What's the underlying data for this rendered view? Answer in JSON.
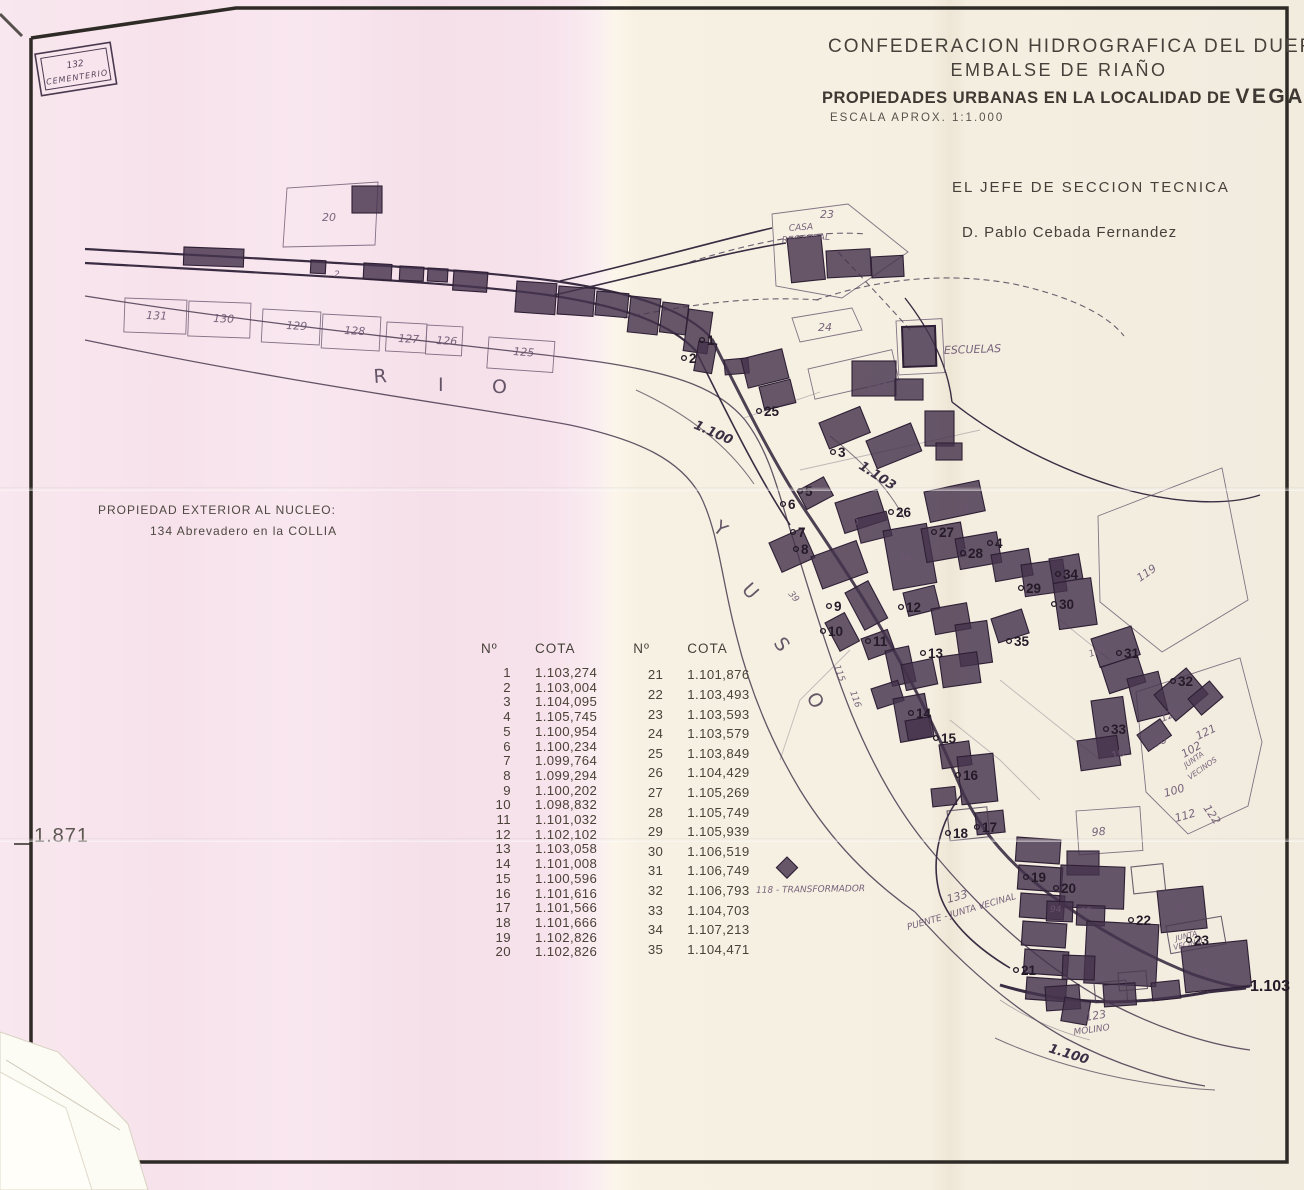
{
  "header": {
    "org": "CONFEDERACION HIDROGRAFICA DEL DUERO",
    "project": "EMBALSE DE RIAÑO",
    "title_prefix": "PROPIEDADES URBANAS EN LA LOCALIDAD DE",
    "title_place": "VEGACERNEJA",
    "scale": "ESCALA APROX. 1:1.000",
    "signature_role": "EL JEFE DE SECCION TECNICA",
    "signature_name": "D. Pablo Cebada Fernandez"
  },
  "sheet_number": "1.871",
  "note": {
    "line1": "PROPIEDAD EXTERIOR AL NUCLEO:",
    "line2": "134  Abrevadero en la COLLIA"
  },
  "table": {
    "col_headers": [
      "Nº",
      "COTA"
    ],
    "left_rows": [
      [
        "1",
        "1.103,274"
      ],
      [
        "2",
        "1.103,004"
      ],
      [
        "3",
        "1.104,095"
      ],
      [
        "4",
        "1.105,745"
      ],
      [
        "5",
        "1.100,954"
      ],
      [
        "6",
        "1.100,234"
      ],
      [
        "7",
        "1.099,764"
      ],
      [
        "8",
        "1.099,294"
      ],
      [
        "9",
        "1.100,202"
      ],
      [
        "10",
        "1.098,832"
      ],
      [
        "11",
        "1.101,032"
      ],
      [
        "12",
        "1.102,102"
      ],
      [
        "13",
        "1.103,058"
      ],
      [
        "14",
        "1.101,008"
      ],
      [
        "15",
        "1.100,596"
      ],
      [
        "16",
        "1.101,616"
      ],
      [
        "17",
        "1.101,566"
      ],
      [
        "18",
        "1.101,666"
      ],
      [
        "19",
        "1.102,826"
      ],
      [
        "20",
        "1.102,826"
      ]
    ],
    "right_rows": [
      [
        "21",
        "1.101,876"
      ],
      [
        "22",
        "1.103,493"
      ],
      [
        "23",
        "1.103,593"
      ],
      [
        "24",
        "1.103,579"
      ],
      [
        "25",
        "1.103,849"
      ],
      [
        "26",
        "1.104,429"
      ],
      [
        "27",
        "1.105,269"
      ],
      [
        "28",
        "1.105,749"
      ],
      [
        "29",
        "1.105,939"
      ],
      [
        "30",
        "1.106,519"
      ],
      [
        "31",
        "1.106,749"
      ],
      [
        "32",
        "1.106,793"
      ],
      [
        "33",
        "1.104,703"
      ],
      [
        "34",
        "1.107,213"
      ],
      [
        "35",
        "1.104,471"
      ]
    ]
  },
  "map": {
    "stamp": {
      "number": "132",
      "label": "CEMENTERIO"
    },
    "labels": [
      {
        "t": "R",
        "x": 374,
        "y": 383,
        "r": -4,
        "c": "river"
      },
      {
        "t": "I",
        "x": 438,
        "y": 391,
        "r": 0,
        "c": "river"
      },
      {
        "t": "O",
        "x": 492,
        "y": 393,
        "r": 0,
        "c": "river"
      },
      {
        "t": "Y",
        "x": 712,
        "y": 530,
        "r": 38,
        "c": "river"
      },
      {
        "t": "U",
        "x": 741,
        "y": 590,
        "r": 48,
        "c": "river"
      },
      {
        "t": "S",
        "x": 773,
        "y": 643,
        "r": 55,
        "c": "river"
      },
      {
        "t": "O",
        "x": 806,
        "y": 697,
        "r": 60,
        "c": "river"
      },
      {
        "t": "1.100",
        "x": 693,
        "y": 428,
        "r": 24,
        "c": "contour"
      },
      {
        "t": "1.103",
        "x": 858,
        "y": 468,
        "r": 33,
        "c": "contour"
      },
      {
        "t": "1.100",
        "x": 1048,
        "y": 1052,
        "r": 17,
        "c": "contour"
      },
      {
        "t": "1.103",
        "x": 1250,
        "y": 991,
        "r": 0,
        "c": "contour-big"
      },
      {
        "t": "ESCUELAS",
        "x": 944,
        "y": 354,
        "r": -2,
        "c": "hand"
      },
      {
        "t": "CASA",
        "x": 789,
        "y": 231,
        "r": -4,
        "c": "hand-s"
      },
      {
        "t": "RECTORAL",
        "x": 782,
        "y": 243,
        "r": -4,
        "c": "hand-s"
      },
      {
        "t": "118 - TRANSFORMADOR",
        "x": 756,
        "y": 893,
        "r": -1,
        "c": "hand-s"
      },
      {
        "t": "PUENTE - JUNTA VECINAL",
        "x": 908,
        "y": 930,
        "r": -16,
        "c": "hand-s"
      },
      {
        "t": "133",
        "x": 948,
        "y": 903,
        "r": -16,
        "c": "hand"
      },
      {
        "t": "123",
        "x": 1086,
        "y": 1021,
        "r": -10,
        "c": "hand"
      },
      {
        "t": "MOLINO",
        "x": 1074,
        "y": 1035,
        "r": -8,
        "c": "hand-s"
      },
      {
        "t": "JUNTA",
        "x": 1176,
        "y": 941,
        "r": -14,
        "c": "hand-t"
      },
      {
        "t": "VECINAL",
        "x": 1174,
        "y": 950,
        "r": -14,
        "c": "hand-t"
      },
      {
        "t": "JUNTA",
        "x": 1186,
        "y": 768,
        "r": -35,
        "c": "hand-t"
      },
      {
        "t": "VECINOS",
        "x": 1190,
        "y": 780,
        "r": -35,
        "c": "hand-t"
      },
      {
        "t": "131",
        "x": 146,
        "y": 319,
        "r": 2,
        "c": "hand"
      },
      {
        "t": "130",
        "x": 213,
        "y": 322,
        "r": 2,
        "c": "hand"
      },
      {
        "t": "129",
        "x": 286,
        "y": 329,
        "r": 3,
        "c": "hand"
      },
      {
        "t": "128",
        "x": 344,
        "y": 334,
        "r": 3,
        "c": "hand"
      },
      {
        "t": "127",
        "x": 398,
        "y": 342,
        "r": 3,
        "c": "hand"
      },
      {
        "t": "126",
        "x": 436,
        "y": 344,
        "r": 3,
        "c": "hand"
      },
      {
        "t": "125",
        "x": 513,
        "y": 355,
        "r": 4,
        "c": "hand"
      },
      {
        "t": "124",
        "x": 868,
        "y": 394,
        "r": -13,
        "c": "hand"
      },
      {
        "t": "20",
        "x": 322,
        "y": 221,
        "r": 0,
        "c": "hand"
      },
      {
        "t": "23",
        "x": 820,
        "y": 218,
        "r": 0,
        "c": "hand"
      },
      {
        "t": "24",
        "x": 818,
        "y": 331,
        "r": 0,
        "c": "hand"
      },
      {
        "t": "2",
        "x": 334,
        "y": 277,
        "r": 0,
        "c": "hand-s"
      },
      {
        "t": "119",
        "x": 1140,
        "y": 582,
        "r": -35,
        "c": "hand"
      },
      {
        "t": "120",
        "x": 1162,
        "y": 722,
        "r": -22,
        "c": "hand"
      },
      {
        "t": "121",
        "x": 1198,
        "y": 740,
        "r": -26,
        "c": "hand"
      },
      {
        "t": "122",
        "x": 1203,
        "y": 808,
        "r": 55,
        "c": "hand"
      },
      {
        "t": "102",
        "x": 1184,
        "y": 758,
        "r": -30,
        "c": "hand"
      },
      {
        "t": "106",
        "x": 1148,
        "y": 750,
        "r": -22,
        "c": "hand"
      },
      {
        "t": "107",
        "x": 1113,
        "y": 760,
        "r": -22,
        "c": "hand"
      },
      {
        "t": "100",
        "x": 1165,
        "y": 797,
        "r": -16,
        "c": "hand"
      },
      {
        "t": "112",
        "x": 1176,
        "y": 822,
        "r": -16,
        "c": "hand"
      },
      {
        "t": "98",
        "x": 1092,
        "y": 836,
        "r": -5,
        "c": "hand"
      },
      {
        "t": "115",
        "x": 834,
        "y": 666,
        "r": 70,
        "c": "hand-s"
      },
      {
        "t": "116",
        "x": 850,
        "y": 692,
        "r": 70,
        "c": "hand-s"
      },
      {
        "t": "39",
        "x": 788,
        "y": 594,
        "r": 50,
        "c": "hand-s"
      },
      {
        "t": "109",
        "x": 1090,
        "y": 657,
        "r": -20,
        "c": "hand-s"
      },
      {
        "t": "96",
        "x": 1070,
        "y": 888,
        "r": 0,
        "c": "hand-s"
      },
      {
        "t": "95",
        "x": 1080,
        "y": 914,
        "r": 0,
        "c": "hand-s"
      },
      {
        "t": "94",
        "x": 1050,
        "y": 912,
        "r": 0,
        "c": "hand-s"
      },
      {
        "t": "77",
        "x": 1112,
        "y": 952,
        "r": 0,
        "c": "hand-s"
      },
      {
        "t": "92",
        "x": 1204,
        "y": 974,
        "r": -6,
        "c": "hand-s"
      },
      {
        "t": "97",
        "x": 1158,
        "y": 996,
        "r": -4,
        "c": "hand-t"
      },
      {
        "t": "76",
        "x": 1174,
        "y": 914,
        "r": -6,
        "c": "hand-s"
      },
      {
        "t": "40",
        "x": 848,
        "y": 527,
        "r": -14,
        "c": "hand-s"
      },
      {
        "t": "16",
        "x": 958,
        "y": 513,
        "r": -8,
        "c": "hand-s"
      },
      {
        "t": "44",
        "x": 900,
        "y": 562,
        "r": -10,
        "c": "hand-s"
      },
      {
        "t": "43",
        "x": 962,
        "y": 556,
        "r": -10,
        "c": "hand-s"
      },
      {
        "t": "54",
        "x": 1066,
        "y": 608,
        "r": -8,
        "c": "hand-s"
      }
    ],
    "markers": [
      {
        "n": "1",
        "x": 702,
        "y": 340
      },
      {
        "n": "2",
        "x": 684,
        "y": 358
      },
      {
        "n": "3",
        "x": 833,
        "y": 452
      },
      {
        "n": "4",
        "x": 990,
        "y": 543
      },
      {
        "n": "5",
        "x": 800,
        "y": 491
      },
      {
        "n": "6",
        "x": 783,
        "y": 504
      },
      {
        "n": "7",
        "x": 793,
        "y": 532
      },
      {
        "n": "8",
        "x": 796,
        "y": 549
      },
      {
        "n": "9",
        "x": 829,
        "y": 606
      },
      {
        "n": "10",
        "x": 823,
        "y": 631
      },
      {
        "n": "11",
        "x": 868,
        "y": 641
      },
      {
        "n": "12",
        "x": 901,
        "y": 607
      },
      {
        "n": "13",
        "x": 923,
        "y": 653
      },
      {
        "n": "14",
        "x": 911,
        "y": 713
      },
      {
        "n": "15",
        "x": 936,
        "y": 738
      },
      {
        "n": "16",
        "x": 958,
        "y": 775
      },
      {
        "n": "17",
        "x": 977,
        "y": 827
      },
      {
        "n": "18",
        "x": 948,
        "y": 833
      },
      {
        "n": "19",
        "x": 1026,
        "y": 877
      },
      {
        "n": "20",
        "x": 1056,
        "y": 888
      },
      {
        "n": "21",
        "x": 1016,
        "y": 970
      },
      {
        "n": "22",
        "x": 1131,
        "y": 920
      },
      {
        "n": "23",
        "x": 1189,
        "y": 940
      },
      {
        "n": "25",
        "x": 759,
        "y": 411
      },
      {
        "n": "26",
        "x": 891,
        "y": 512
      },
      {
        "n": "27",
        "x": 934,
        "y": 532
      },
      {
        "n": "28",
        "x": 963,
        "y": 553
      },
      {
        "n": "29",
        "x": 1021,
        "y": 588
      },
      {
        "n": "30",
        "x": 1054,
        "y": 604
      },
      {
        "n": "31",
        "x": 1119,
        "y": 653
      },
      {
        "n": "32",
        "x": 1173,
        "y": 681
      },
      {
        "n": "33",
        "x": 1106,
        "y": 729
      },
      {
        "n": "34",
        "x": 1058,
        "y": 574
      },
      {
        "n": "35",
        "x": 1009,
        "y": 641
      }
    ]
  }
}
